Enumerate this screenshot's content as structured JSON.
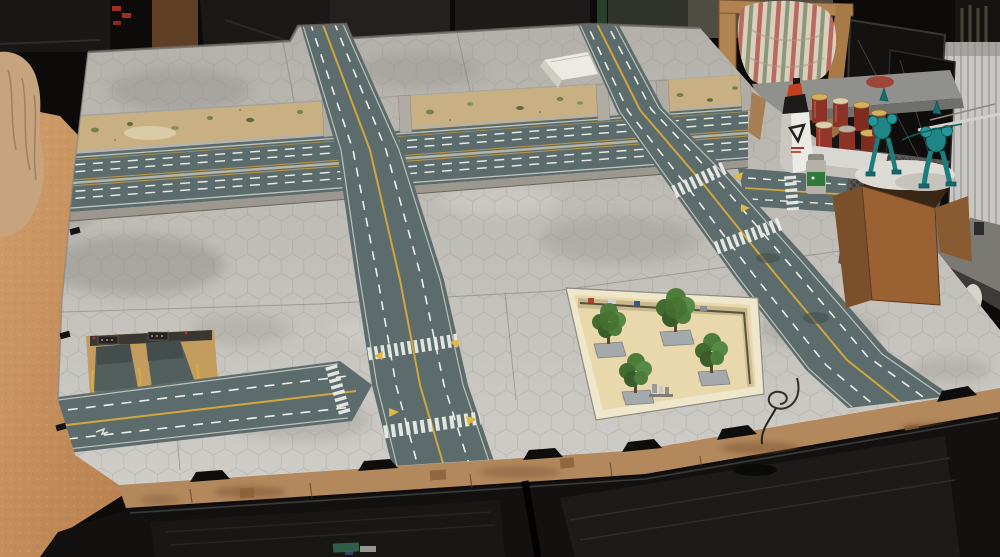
{
  "scene": {
    "type": "photograph",
    "subject": "Modular hex-grid wargaming board with printed city roads, a sunken highway, underground garage ramps and a tree-filled park tile, set up on a table in a hobby room",
    "board_features": [
      "hex-grid city tiles",
      "sunken multi-lane highway with dirt embankments",
      "overpass road running top to bottom",
      "T-intersection with zebra crosswalks",
      "side road exiting the left edge",
      "right-hand road with branch junction",
      "underground garage ramp tile",
      "park tile with four model trees",
      "laser-cut MDF edge with black clips"
    ],
    "room_items": [
      "orange wooden table top",
      "rock outcrop terrain piece",
      "wooden chair with striped cushion",
      "white radiator",
      "leaning picture frames",
      "white glue bottle",
      "tray of red-brown jars",
      "teal mech miniatures on a white base",
      "diagonal-mesh terrain panel",
      "open cardboard box",
      "gray side workbench with miniatures",
      "black cabinet with fabric drawers"
    ]
  },
  "palette": {
    "room_shadow": "#0c0b0a",
    "wood_table": "#c9925f",
    "rock_outcrop": "#c5a47e",
    "board_tile_light": "#d0cec9",
    "board_tile_dark": "#b3b0aa",
    "hex_grid_line": "#8f8b83",
    "road_surface": "#5c6b6b",
    "road_marking_white": "#eef0ea",
    "road_marking_yellow": "#cfa63f",
    "dirt_embankment": "#c9b083",
    "vegetation_green": "#74804c",
    "concrete_wall": "#b0aca3",
    "park_floor": "#e9d8ac",
    "tree_canopy": "#4e7c3b",
    "tree_base": "#a4a9ac",
    "mdf_edge": "#b2885c",
    "clip_black": "#0d0d0c",
    "furniture_black": "#121110",
    "cushion_cream": "#d9cfbf",
    "cushion_stripe_red": "#b4584c",
    "cushion_stripe_green": "#7e8d6b",
    "chair_wood": "#b08350",
    "seat_gray": "#90908c",
    "radiator_white": "#c9c7c3",
    "glue_bottle_white": "#eceae4",
    "jar_red": "#8c3226",
    "jar_lid_gold": "#d2b25c",
    "mini_teal": "#1f8585",
    "cardboard_brown": "#9a6233",
    "panel_dark_gray": "#3f3e3b",
    "side_table_gray": "#7b7974",
    "garage_tan": "#c49c5e",
    "garage_ramp_dark": "#525f5c",
    "ramp_wedge_white": "#eceae2"
  }
}
